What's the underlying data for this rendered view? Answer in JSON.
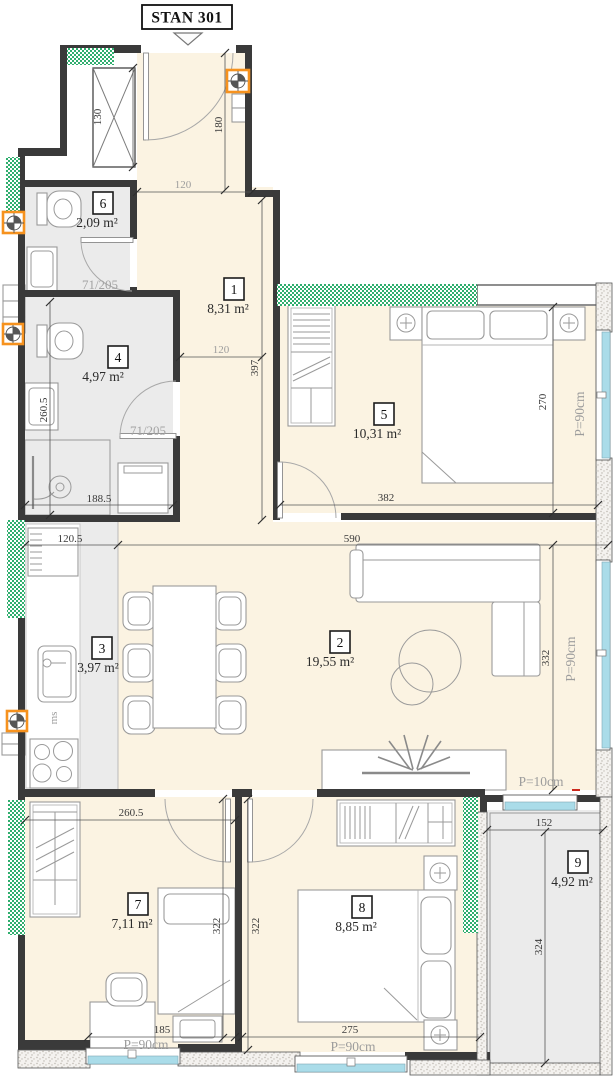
{
  "title": "STAN 301",
  "rooms": [
    {
      "id": "1",
      "area": "8,31 m²"
    },
    {
      "id": "2",
      "area": "19,55 m²"
    },
    {
      "id": "3",
      "area": "3,97 m²"
    },
    {
      "id": "4",
      "area": "4,97 m²"
    },
    {
      "id": "5",
      "area": "10,31 m²"
    },
    {
      "id": "6",
      "area": "2,09 m²"
    },
    {
      "id": "7",
      "area": "7,11 m²"
    },
    {
      "id": "8",
      "area": "8,85 m²"
    },
    {
      "id": "9",
      "area": "4,92 m²"
    }
  ],
  "dims": {
    "d130": "130",
    "d180": "180",
    "d120a": "120",
    "d120b": "120",
    "d397": "397",
    "d260_5a": "260.5",
    "d188_5": "188.5",
    "d382": "382",
    "d270": "270",
    "d120_5": "120.5",
    "d590": "590",
    "d332": "332",
    "d152": "152",
    "d324": "324",
    "d260_5b": "260.5",
    "d322a": "322",
    "d322b": "322",
    "d185": "185",
    "d275": "275"
  },
  "doors": {
    "wc": "71/205",
    "bathroom": "71/205"
  },
  "parapets": {
    "p90": "P=90cm",
    "p10": "P=10cm"
  },
  "labels": {
    "dishwasher": "ms"
  },
  "colors": {
    "floor_cream": "#fbf3e2",
    "floor_gray": "#ebebeb",
    "wall_dark": "#3a3a3a",
    "green": "#2fae6e",
    "window_cyan": "#aadce9",
    "accent_orange": "#f6921e",
    "dim_gray": "#9d9d9d",
    "red_mark": "#cc2a1e"
  }
}
